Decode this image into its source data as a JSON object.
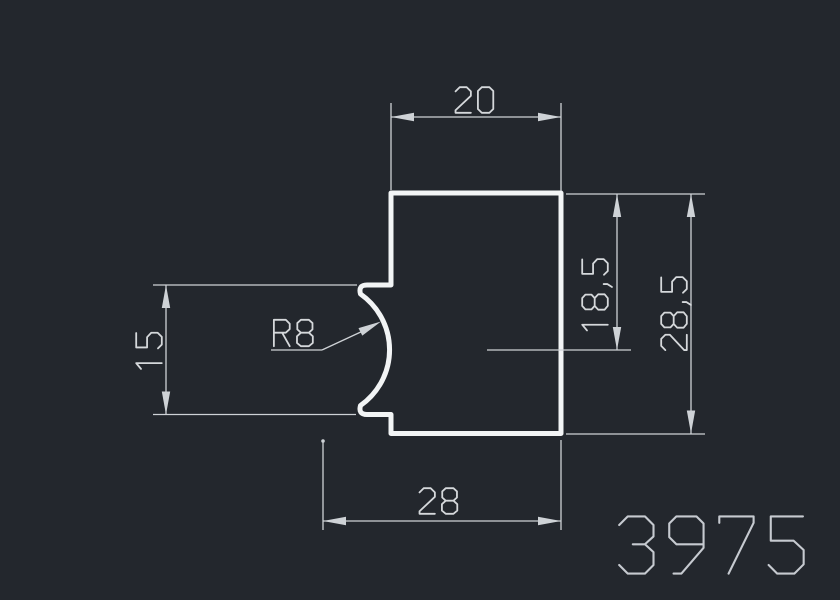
{
  "drawing": {
    "part_number": "3975",
    "labels": {
      "top_width": "20",
      "right_inner_height": "18,5",
      "right_outer_height": "28,5",
      "left_notch_height": "15",
      "bottom_width": "28",
      "notch_radius": "R8"
    },
    "colors": {
      "background": "#23272d",
      "outline": "#f2f4f5",
      "dimension_lines": "#ced2d6",
      "dimension_text": "#d5d8db",
      "part_number_text": "#c6cad0"
    }
  }
}
